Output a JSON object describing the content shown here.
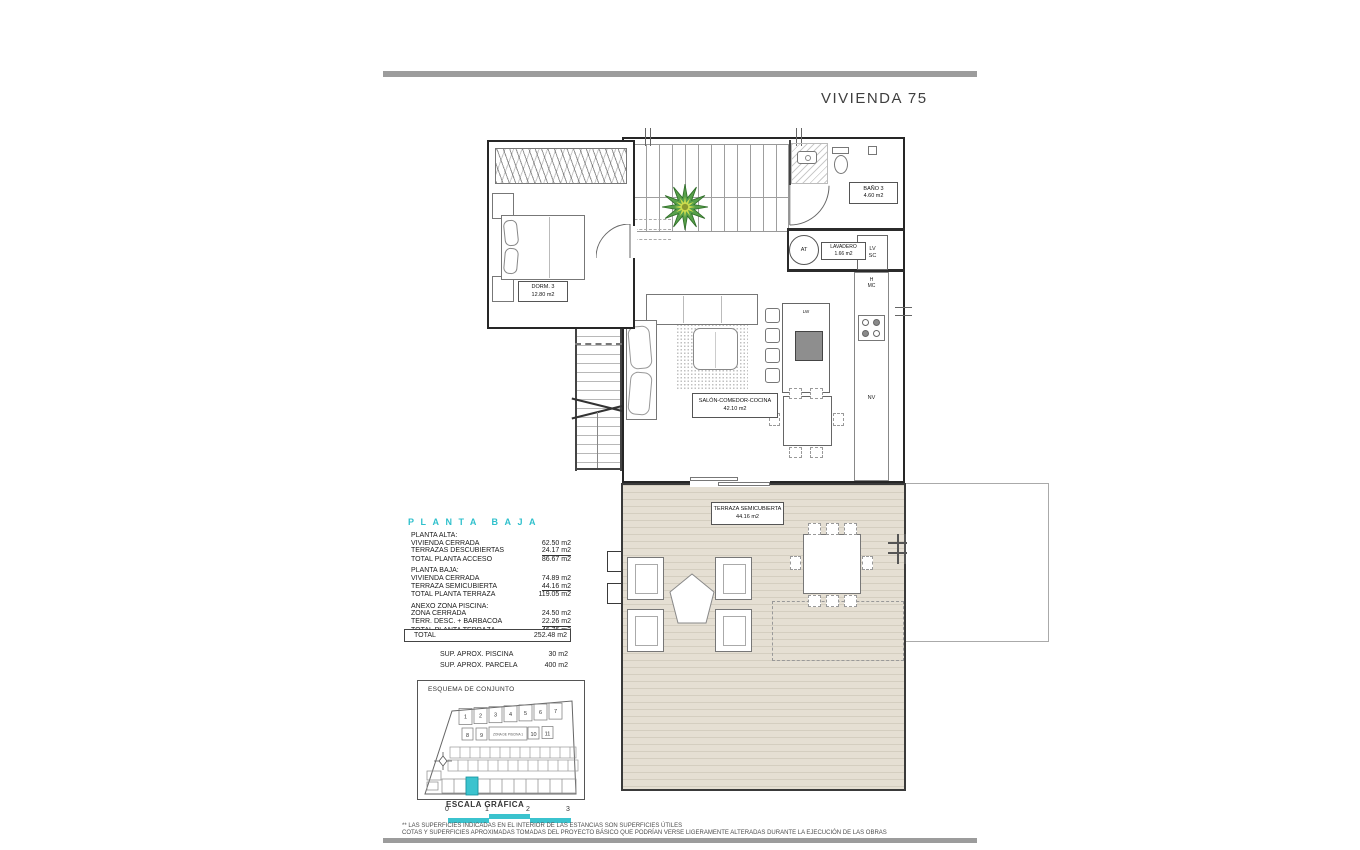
{
  "title": "VIVIENDA 75",
  "accent_color": "#3bc3ce",
  "plan": {
    "rooms": {
      "dorm3": {
        "name": "DORM. 3",
        "area": "12.80 m2"
      },
      "bano3": {
        "name": "BAÑO 3",
        "area": "4.60 m2"
      },
      "lavadero": {
        "name": "LAVADERO",
        "area": "1.66 m2"
      },
      "salon": {
        "name": "SALÓN-COMEDOR-COCINA",
        "area": "42.10 m2"
      },
      "terraza": {
        "name": "TERRAZA SEMICUBIERTA",
        "area": "44.16 m2"
      }
    },
    "tags": {
      "at": "AT",
      "lv": "LV",
      "sc": "SC",
      "h": "H",
      "mc": "MC",
      "nv": "NV",
      "lw": "LW"
    }
  },
  "legend": {
    "title": "PLANTA BAJA",
    "rows": [
      {
        "label": "PLANTA ALTA:",
        "value": ""
      },
      {
        "label": "VIVIENDA CERRADA",
        "value": "62.50 m2"
      },
      {
        "label": "TERRAZAS DESCUBIERTAS",
        "value": "24.17 m2"
      },
      {
        "label": "TOTAL PLANTA ACCESO",
        "value": "86.67 m2"
      },
      {
        "label": "PLANTA BAJA:",
        "value": ""
      },
      {
        "label": "VIVIENDA CERRADA",
        "value": "74.89 m2"
      },
      {
        "label": "TERRAZA SEMICUBIERTA",
        "value": "44.16 m2"
      },
      {
        "label": "TOTAL PLANTA TERRAZA",
        "value": "119.05 m2"
      },
      {
        "label": "ANEXO ZONA PISCINA:",
        "value": ""
      },
      {
        "label": "ZONA CERRADA",
        "value": "24.50 m2"
      },
      {
        "label": "TERR. DESC. + BARBACOA",
        "value": "22.26 m2"
      },
      {
        "label": "TOTAL PLANTA TERRAZA",
        "value": "46.76 m2"
      }
    ],
    "total": {
      "label": "TOTAL",
      "value": "252.48 m2"
    },
    "extras": [
      {
        "label": "SUP.  APROX.  PISCINA",
        "value": "30 m2"
      },
      {
        "label": "SUP.  APROX.  PARCELA",
        "value": "400 m2"
      }
    ]
  },
  "site_plan": {
    "title": "ESQUEMA DE CONJUNTO",
    "plot_numbers": [
      "1",
      "2",
      "3",
      "4",
      "5",
      "6",
      "7",
      "8",
      "9",
      "10",
      "11"
    ],
    "pool_label": "ZONA DE PISCINA 1"
  },
  "scale_bar": {
    "title": "ESCALA GRÁFICA",
    "ticks": [
      "0",
      "1",
      "2",
      "3"
    ]
  },
  "footer": {
    "line1": "** LAS SUPERFICIES INDICADAS EN EL INTERIOR DE LAS ESTANCIAS SON SUPERFICIES ÚTILES",
    "line2": "COTAS Y SUPERFICIES APROXIMADAS TOMADAS DEL PROYECTO BÁSICO QUE PODRÍAN VERSE LIGERAMENTE ALTERADAS DURANTE LA EJECUCIÓN DE LAS OBRAS"
  }
}
